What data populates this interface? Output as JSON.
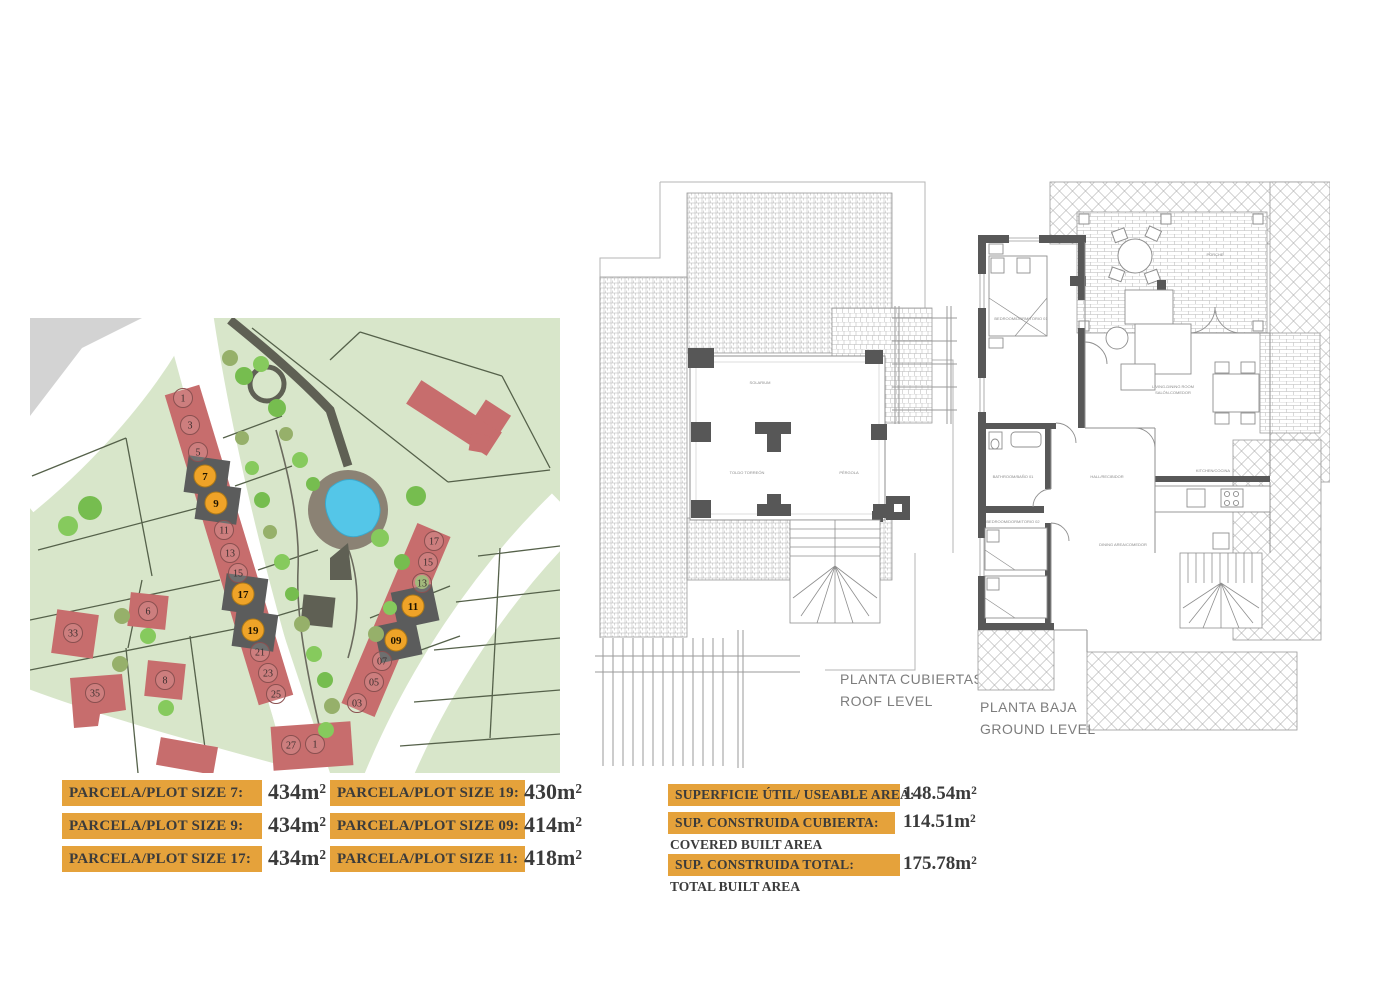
{
  "colors": {
    "accent_orange": "#e5a23b",
    "building_red": "#c76d6d",
    "site_green": "#d8e6ca",
    "pool_blue": "#54c6e8",
    "path_dark": "#5f6054",
    "wall_dark": "#585858",
    "line_gray": "#9c9c9c",
    "text_dark": "#3b3b3b",
    "title_gray": "#7d7d7d"
  },
  "site_plan": {
    "standard_plots": [
      "1",
      "3",
      "5",
      "11",
      "13",
      "15",
      "21",
      "23",
      "25",
      "27",
      "1",
      "17",
      "15",
      "13",
      "07",
      "05",
      "03",
      "33",
      "6",
      "8",
      "35"
    ],
    "highlight_plots": [
      "7",
      "9",
      "17",
      "19",
      "11",
      "09"
    ]
  },
  "roof_plan": {
    "title_es": "PLANTA CUBIERTAS",
    "title_en": "ROOF LEVEL",
    "rooms": {
      "solarium": "SOLARIUM",
      "toldo": "TOLDO TORREÓN",
      "pergola": "PÉRGOLA"
    }
  },
  "ground_plan": {
    "title_es": "PLANTA BAJA",
    "title_en": "GROUND LEVEL",
    "rooms": {
      "bedroom1": "BEDROOM/DORMITORIO 01",
      "living1": "LIVING-DINING ROOM",
      "living2": "SALÓN-COMEDOR",
      "bathroom": "BATHROOM/BAÑO 01",
      "hall": "HALL/RECIBIDOR",
      "kitchen": "KITCHEN/COCINA",
      "bedroom2": "BEDROOM/DORMITORIO 02",
      "porch": "PORCHE",
      "distributor": "DINING AREA/COMEDOR"
    }
  },
  "plot_sizes": [
    {
      "label": "PARCELA/PLOT SIZE 7:",
      "value": "434m²"
    },
    {
      "label": "PARCELA/PLOT SIZE 9:",
      "value": "434m²"
    },
    {
      "label": "PARCELA/PLOT SIZE 17:",
      "value": "434m²"
    },
    {
      "label": "PARCELA/PLOT SIZE 19:",
      "value": "430m²"
    },
    {
      "label": "PARCELA/PLOT SIZE 09:",
      "value": "414m²"
    },
    {
      "label": "PARCELA/PLOT SIZE 11:",
      "value": "418m²"
    }
  ],
  "areas": [
    {
      "label": "SUPERFICIE ÚTIL/ USEABLE AREA:",
      "value": "148.54m²",
      "sublabel": ""
    },
    {
      "label": "SUP. CONSTRUIDA CUBIERTA:",
      "value": "114.51m²",
      "sublabel": "COVERED BUILT AREA"
    },
    {
      "label": "SUP. CONSTRUIDA TOTAL:",
      "value": "175.78m²",
      "sublabel": "TOTAL BUILT AREA"
    }
  ]
}
